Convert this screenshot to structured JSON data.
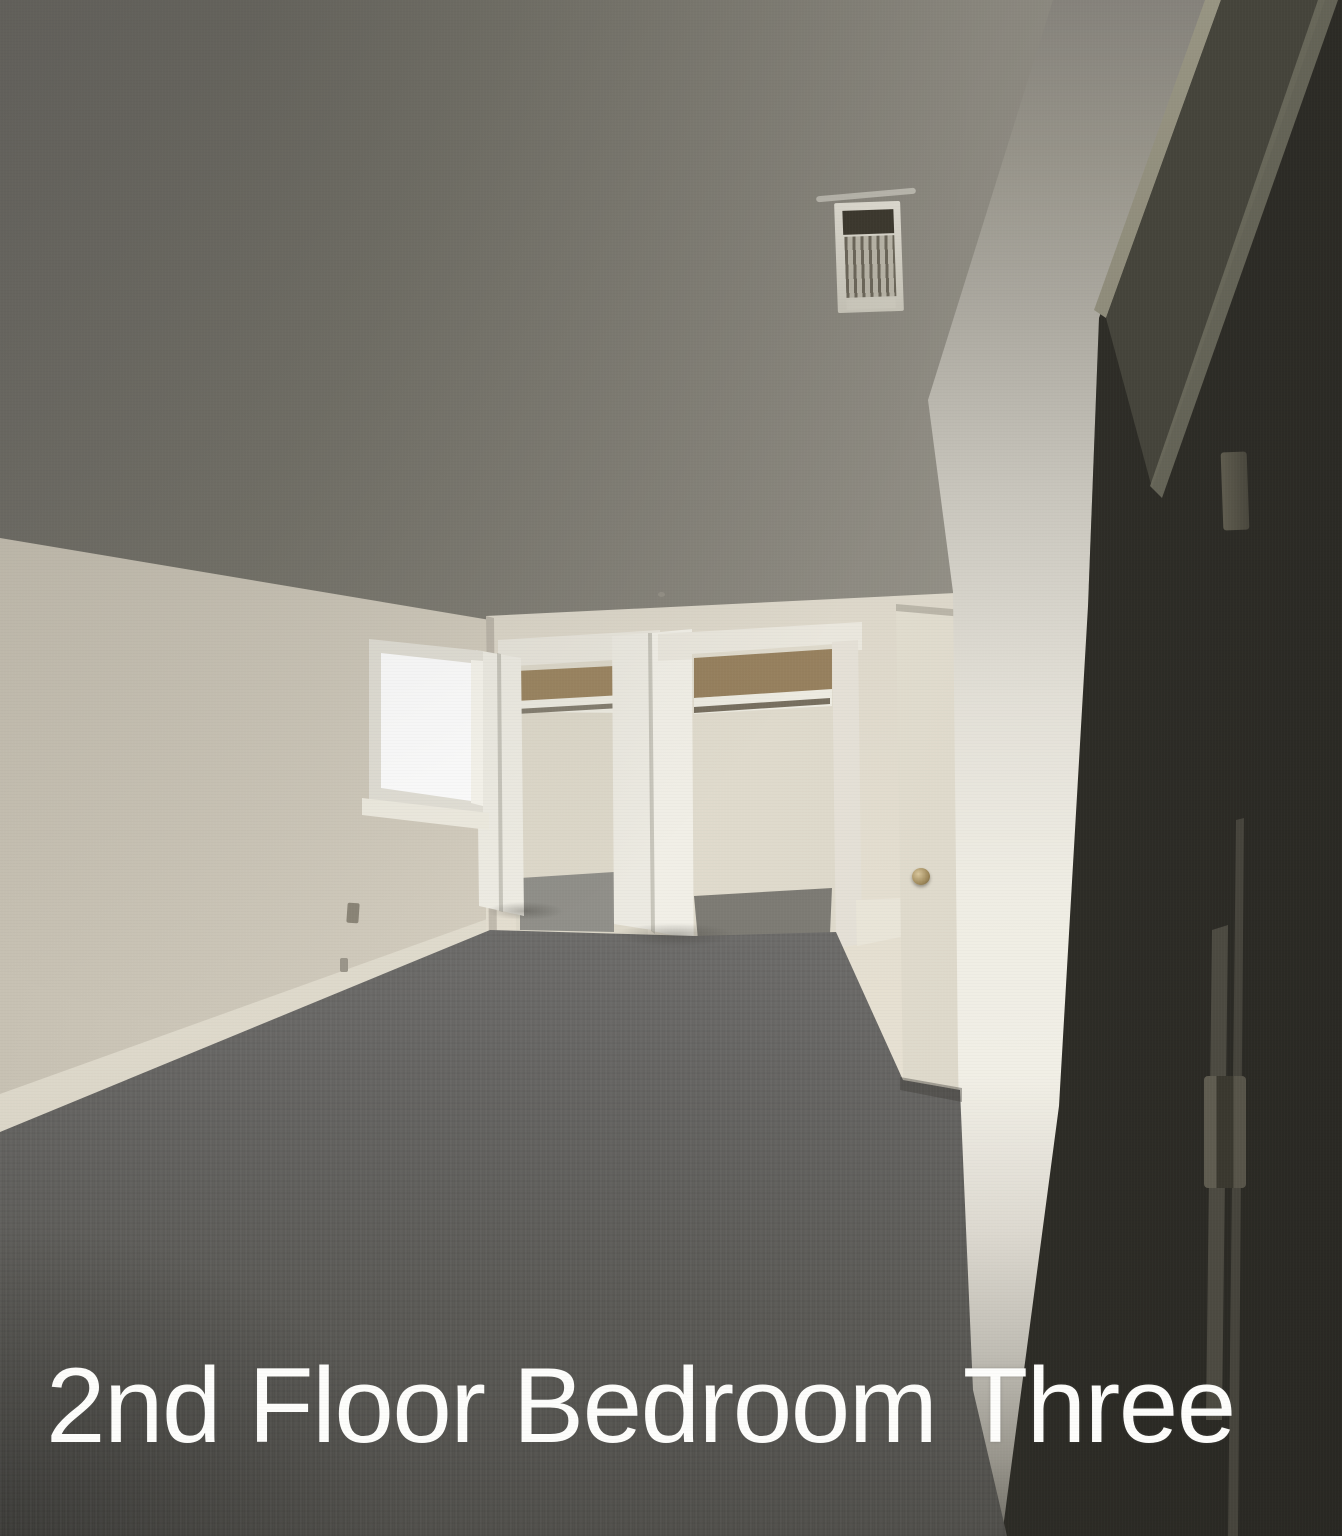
{
  "caption": {
    "text": "2nd Floor Bedroom Three"
  },
  "colors": {
    "caption_text": "#fdfdfb",
    "ceiling_gray": "#8b887f",
    "wall_cream": "#e6dfd0",
    "closet_interior": "#e2ddcf",
    "closet_upper_wood": "#9a8462",
    "bifold_door_white": "#efede5",
    "entry_door_white": "#e6e1d3",
    "doorknob_brass": "#a08a5c",
    "window_glare_white": "#ffffff",
    "carpet_gray": "#7d7c79",
    "dark_door_shadow": "#32302a"
  }
}
